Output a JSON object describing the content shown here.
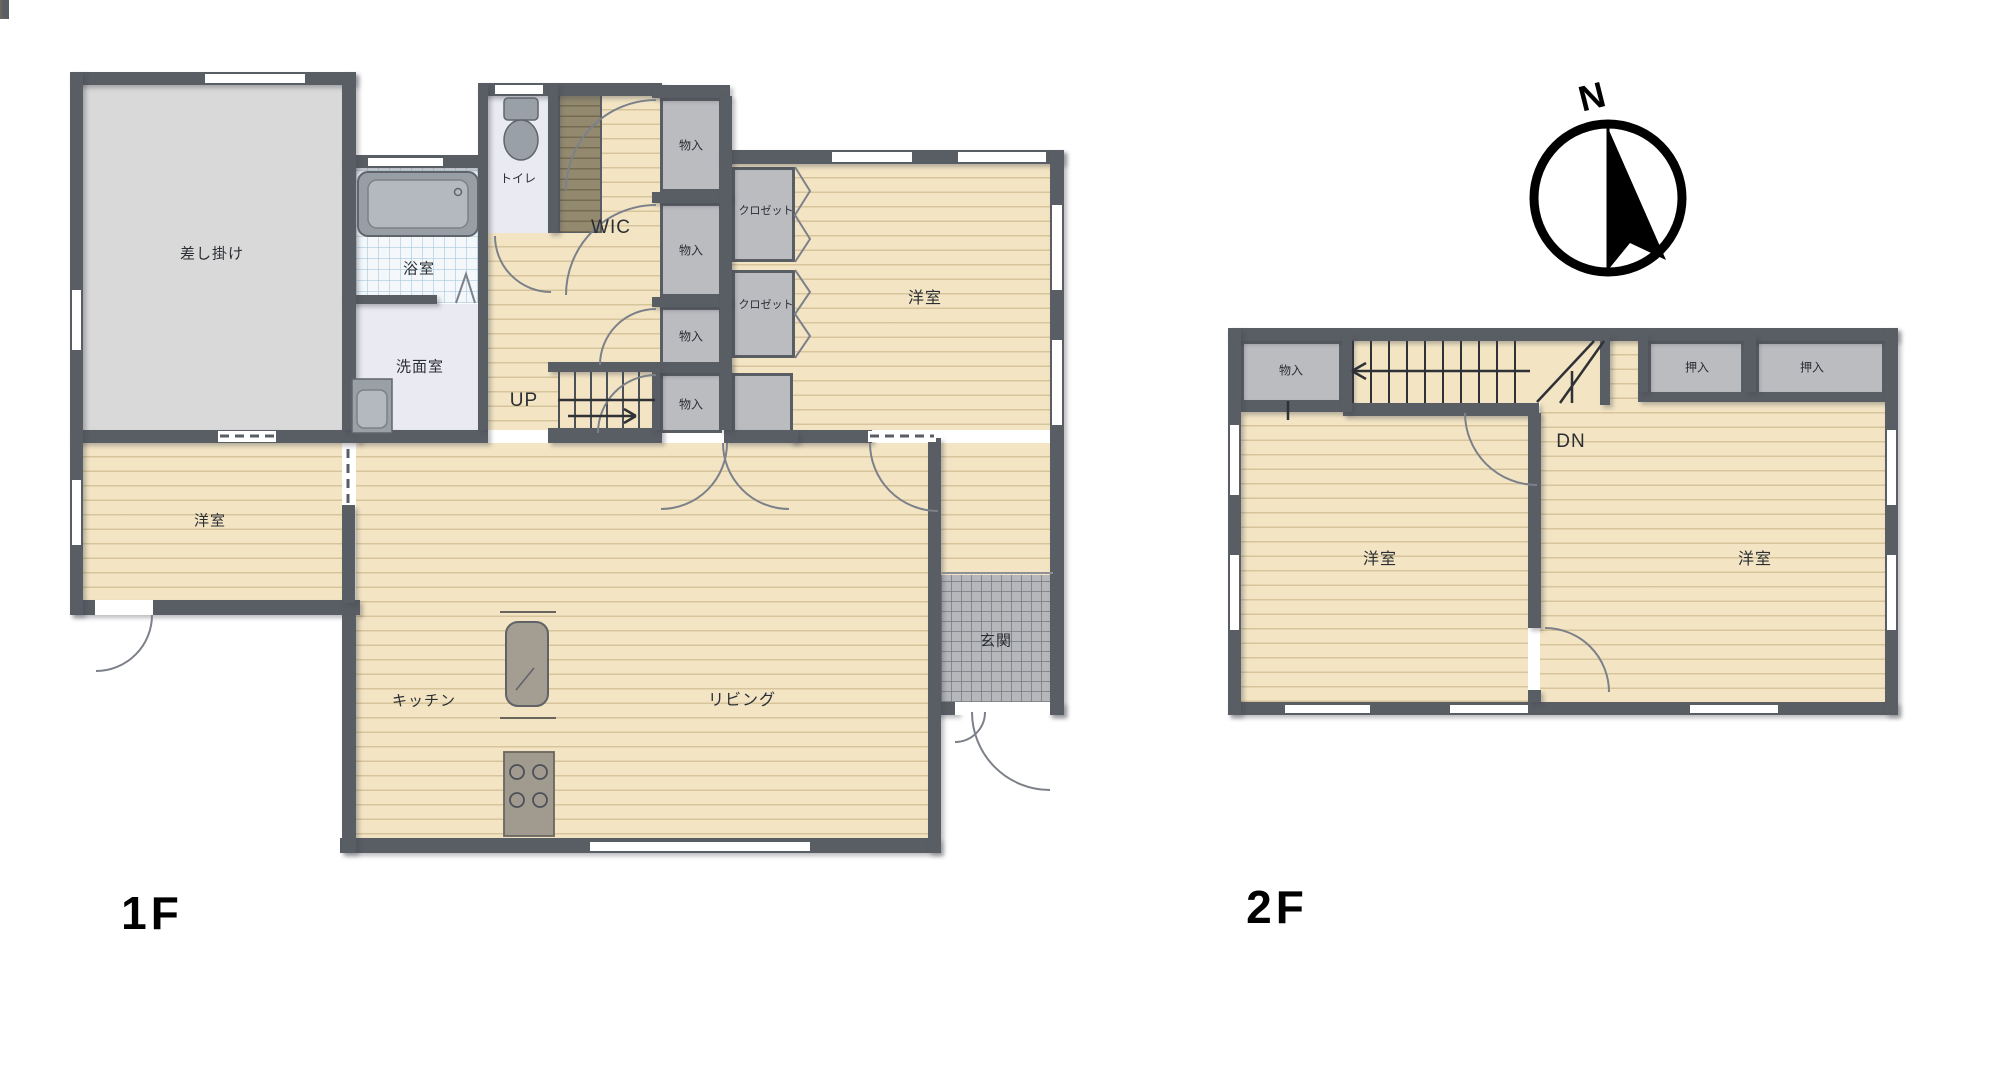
{
  "floor1": {
    "label": "1F",
    "rooms": {
      "sashikake": "差し掛け",
      "bath": "浴室",
      "washroom": "洗面室",
      "toilet": "トイレ",
      "wic": "WIC",
      "stairs_up": "UP",
      "storage": [
        "物入",
        "物入",
        "物入",
        "物入"
      ],
      "closets": [
        "クロゼット",
        "クロゼット"
      ],
      "bedroom_ne": "洋室",
      "bedroom_w": "洋室",
      "kitchen": "キッチン",
      "living": "リビング",
      "entrance": "玄関"
    }
  },
  "floor2": {
    "label": "2F",
    "rooms": {
      "storage": "物入",
      "stairs_down": "DN",
      "oshiire": [
        "押入",
        "押入"
      ],
      "bedroom_left": "洋室",
      "bedroom_right": "洋室"
    }
  },
  "compass": {
    "north_label": "N"
  },
  "colors": {
    "wall": "#595d64",
    "wood_floor": "#f3e5c4",
    "gray_room": "#d9d9d9",
    "storage_fill": "#babcc0",
    "bath_tile": "#f4f8fb",
    "lavender_floor": "#e9eaf2",
    "entrance_tile": "#b5b7ba",
    "counter": "#8f8a7e",
    "wic_closet": "#92896f"
  }
}
